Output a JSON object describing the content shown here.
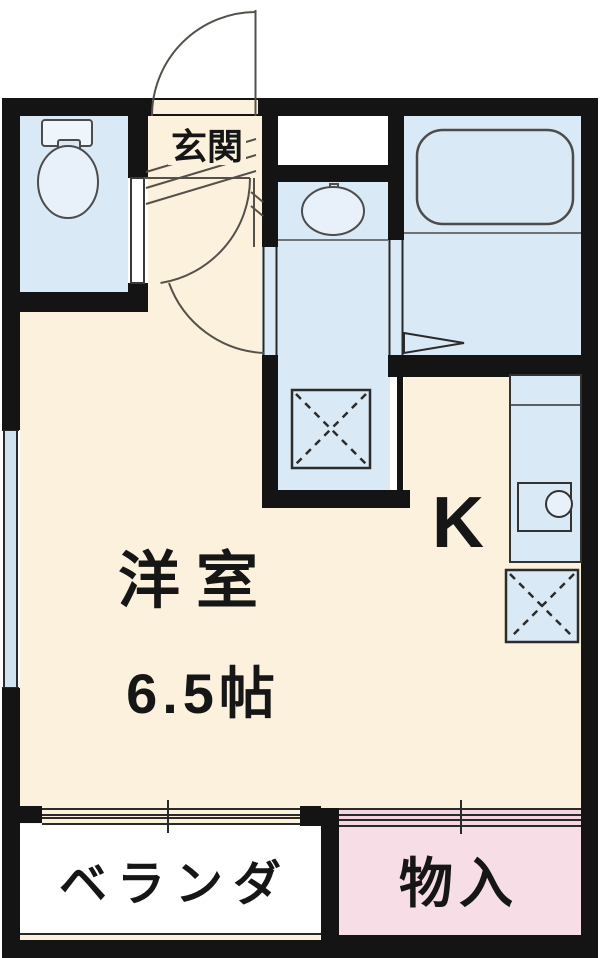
{
  "floorplan": {
    "rooms": {
      "genkan": {
        "label": "玄関"
      },
      "western_room": {
        "label": "洋室",
        "size": "6.5帖"
      },
      "kitchen": {
        "label": "K"
      },
      "veranda": {
        "label": "ベランダ"
      },
      "closet": {
        "label": "物入"
      }
    },
    "fixtures": [
      "toilet",
      "bathtub",
      "washbasin",
      "kitchen-sink",
      "washing-machine-space",
      "refrigerator-space"
    ],
    "colors": {
      "wall": "#141414",
      "room_cream": "#fbf1dc",
      "wet_area_blue": "#d9e9f5",
      "window_blue": "#cfe2f0",
      "closet_pink": "#f7dde6",
      "closet_door_pink": "#f5d5e0",
      "veranda_white": "#ffffff",
      "door_line": "#55514a"
    }
  }
}
